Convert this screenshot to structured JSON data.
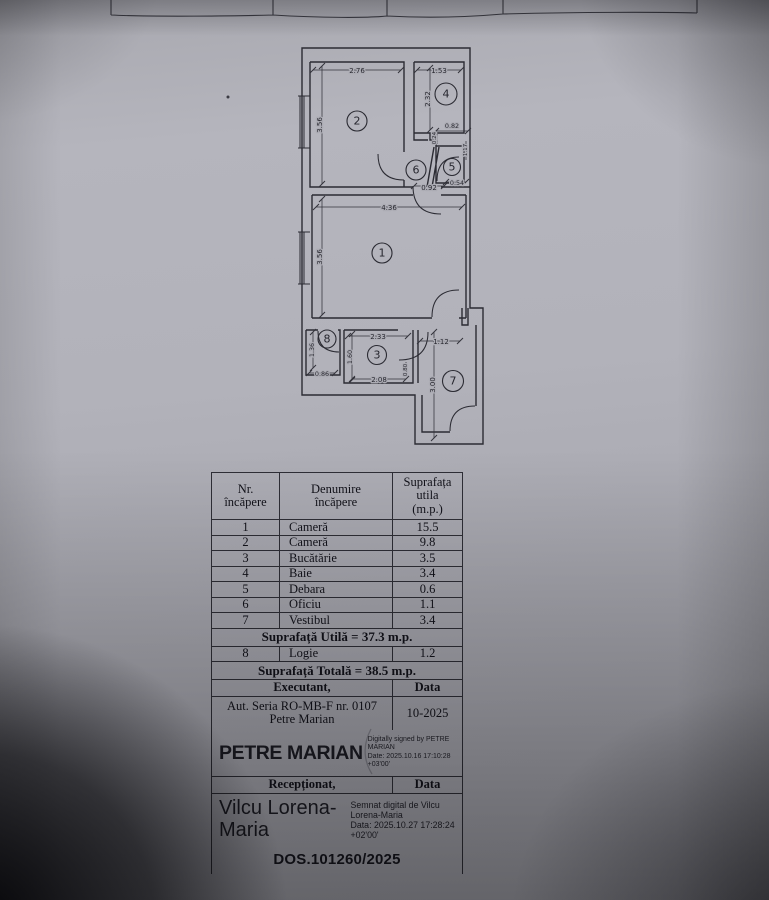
{
  "plan": {
    "rooms": [
      {
        "num": "1"
      },
      {
        "num": "2"
      },
      {
        "num": "3"
      },
      {
        "num": "4"
      },
      {
        "num": "5"
      },
      {
        "num": "6"
      },
      {
        "num": "7"
      },
      {
        "num": "8"
      }
    ],
    "dims": [
      {
        "v": "2.76"
      },
      {
        "v": "1.53"
      },
      {
        "v": "3.56"
      },
      {
        "v": "2.32"
      },
      {
        "v": "0.82"
      },
      {
        "v": "0.24"
      },
      {
        "v": "1.17"
      },
      {
        "v": "0.54"
      },
      {
        "v": "0.92"
      },
      {
        "v": "4.36"
      },
      {
        "v": "3.56"
      },
      {
        "v": "2.33"
      },
      {
        "v": "1.12"
      },
      {
        "v": "1.36"
      },
      {
        "v": "1.60"
      },
      {
        "v": "0.86"
      },
      {
        "v": "2.08"
      },
      {
        "v": "0.80"
      },
      {
        "v": "3.00"
      }
    ]
  },
  "table": {
    "header": {
      "col1": [
        "Nr.",
        "încăpere"
      ],
      "col2": [
        "Denumire",
        "încăpere"
      ],
      "col3": [
        "Suprafața",
        "utila",
        "(m.p.)"
      ]
    },
    "rows": [
      {
        "nr": "1",
        "name": "Cameră",
        "area": "15.5"
      },
      {
        "nr": "2",
        "name": "Cameră",
        "area": "9.8"
      },
      {
        "nr": "3",
        "name": "Bucătărie",
        "area": "3.5"
      },
      {
        "nr": "4",
        "name": "Baie",
        "area": "3.4"
      },
      {
        "nr": "5",
        "name": "Debara",
        "area": "0.6"
      },
      {
        "nr": "6",
        "name": "Oficiu",
        "area": "1.1"
      },
      {
        "nr": "7",
        "name": "Vestibul",
        "area": "3.4"
      }
    ],
    "subtotal": "Suprafață Utilă = 37.3 m.p.",
    "row8": {
      "nr": "8",
      "name": "Logie",
      "area": "1.2"
    },
    "total": "Suprafață Totală = 38.5 m.p.",
    "executant": {
      "label": "Executant,",
      "data_label": "Data",
      "aut_line1": "Aut. Seria RO-MB-F nr. 0107",
      "aut_line2": "Petre Marian",
      "date": "10-2025",
      "signature_name": "PETRE MARIAN",
      "sig_line1": "Digitally signed by PETRE MARIAN",
      "sig_line2": "Date: 2025.10.16 17:10:28 +03'00'"
    },
    "receptionat": {
      "label": "Recepționat,",
      "data_label": "Data",
      "name_line1": "Vilcu Lorena-",
      "name_line2": "Maria",
      "sig_line1": "Semnat digital de Vilcu",
      "sig_line2": "Lorena-Maria",
      "sig_line3": "Data: 2025.10.27 17:28:24",
      "sig_line4": "+02'00'"
    },
    "dossier": "DOS.101260/2025"
  }
}
